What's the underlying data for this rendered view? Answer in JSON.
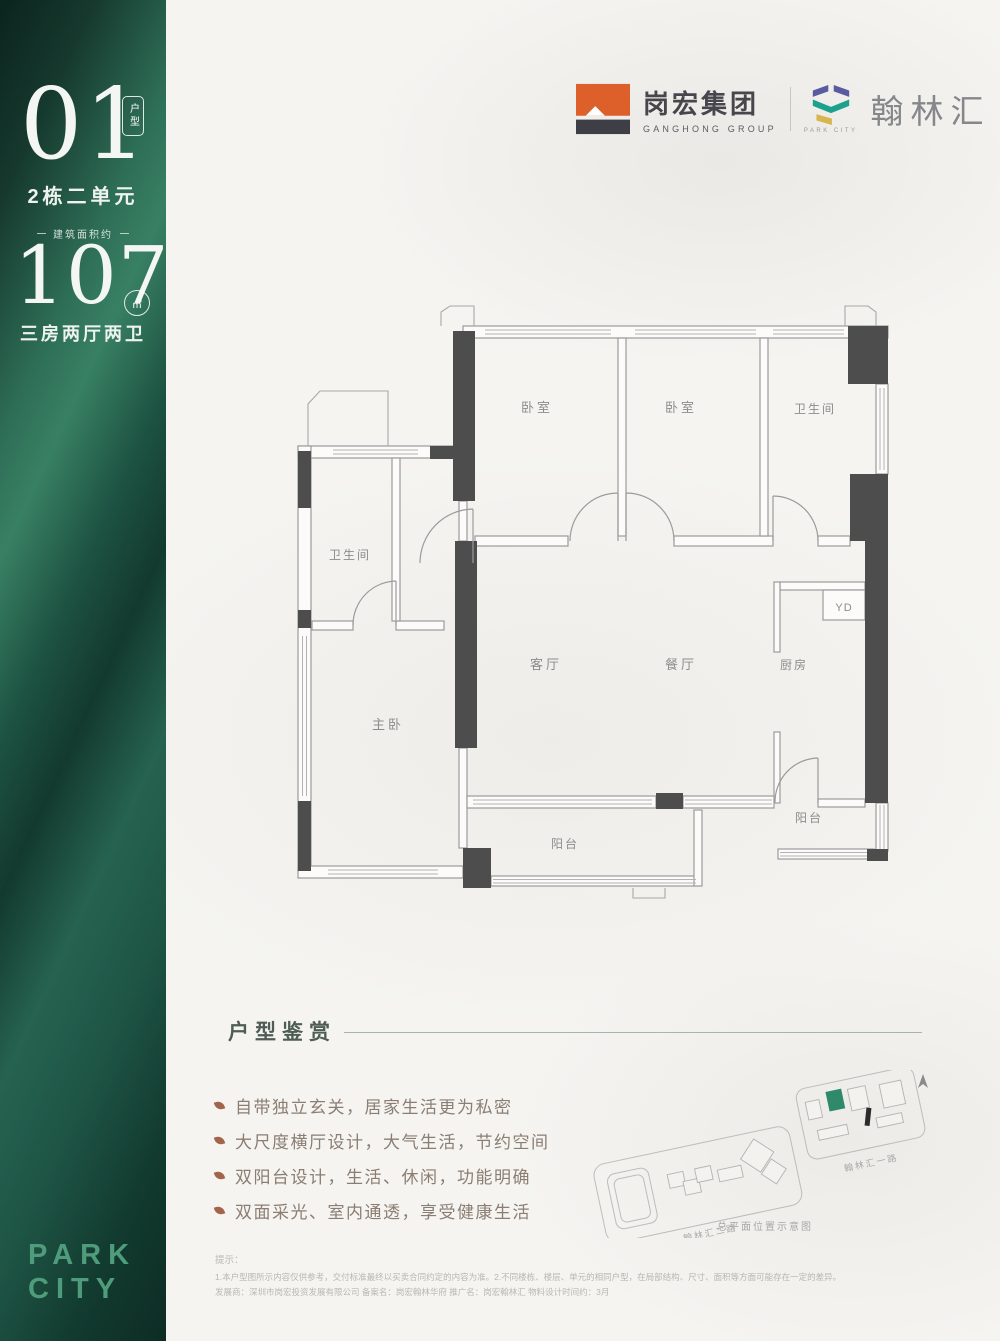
{
  "sidebar": {
    "unit_number": "01",
    "unit_badge": "户型",
    "building": "2栋二单元",
    "area_prefix": "建筑面积约",
    "area_value": "107",
    "area_unit": "㎡",
    "layout_text": "三房两厅两卫",
    "brand_word1": "PARK",
    "brand_word2": "CITY"
  },
  "header": {
    "developer_cn": "岗宏集团",
    "developer_en": "GANGHONG GROUP",
    "project_brand_en": "PARK CITY",
    "project_cn": "翰林汇"
  },
  "floor_plan": {
    "rooms": {
      "bedroom_1": "卧室",
      "bedroom_2": "卧室",
      "bathroom_top": "卫生间",
      "bathroom_left": "卫生间",
      "master_bedroom": "主卧",
      "living_room": "客厅",
      "dining_room": "餐厅",
      "kitchen": "厨房",
      "duct": "YD",
      "balcony_center": "阳台",
      "balcony_right": "阳台"
    }
  },
  "features": {
    "title": "户型鉴赏",
    "items": [
      "自带独立玄关，居家生活更为私密",
      "大尺度横厅设计，大气生活，节约空间",
      "双阳台设计，生活、休闲，功能明确",
      "双面采光、室内通透，享受健康生活"
    ]
  },
  "site_map": {
    "road_label_left": "翰林汇二路",
    "road_label_right": "翰林汇一路",
    "caption": "总平面位置示意图"
  },
  "disclaimer": {
    "heading": "提示：",
    "line_1": "1.本户型图所示内容仅供参考，交付标准最终以买卖合同约定的内容为准。2.不同楼栋、楼层、单元的相同户型，在局部结构、尺寸、面积等方面可能存在一定的差异。",
    "line_2": "发展商：深圳市岗宏投资发展有限公司 备案名：岗宏翰林华府 推广名：岗宏翰林汇 物料设计时间约：3月"
  },
  "colors": {
    "sidebar_green": "#1d5444",
    "brand_green": "#4f9c7c",
    "logo_orange": "#dd5f2a",
    "logo_dark": "#3e3e46",
    "logo_purple": "#5a5aa0",
    "logo_teal": "#1ba18e",
    "logo_yellow": "#d8b64d",
    "wall_dark": "#4d4d4d",
    "bullet_accent": "#a2654c"
  }
}
